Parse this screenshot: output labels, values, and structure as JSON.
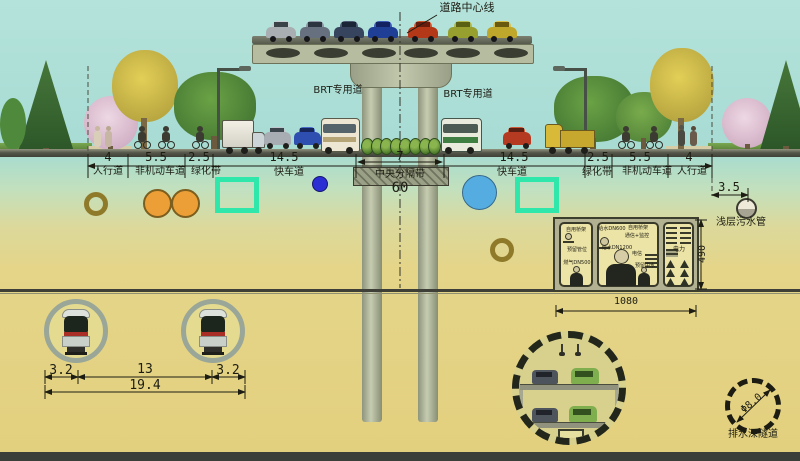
{
  "labels": {
    "road_centerline": "道路中心线",
    "brt_left": "BRT专用道",
    "brt_right": "BRT专用道",
    "median": "中央分隔带",
    "median_width": "7",
    "total_width": "60",
    "sewer_offset": "3.5",
    "shallow_sewer": "浅层污水管",
    "deep_tunnel_dia": "Φ8.0",
    "deep_tunnel": "排水深隧道"
  },
  "lanes_left": [
    {
      "width": "4",
      "name": "人行道"
    },
    {
      "width": "5.5",
      "name": "非机动车道"
    },
    {
      "width": "2.5",
      "name": "绿化带"
    },
    {
      "width": "14.5",
      "name": "快车道"
    }
  ],
  "lanes_right": [
    {
      "width": "14.5",
      "name": "快车道"
    },
    {
      "width": "2.5",
      "name": "绿化带"
    },
    {
      "width": "5.5",
      "name": "非机动车道"
    },
    {
      "width": "4",
      "name": "人行道"
    }
  ],
  "utility_gallery": {
    "width_dim": "1080",
    "height_dim": "490",
    "gas_compartment": [
      "自用桥架",
      "预留管位",
      "燃气DN500"
    ],
    "water_compartment": [
      "给水DN600",
      "自用桥架",
      "通信+监控",
      "给水DN1200",
      "电信",
      "预留中水"
    ],
    "power_compartment": [
      "电力"
    ]
  },
  "metro_tunnels": {
    "left": "3.2",
    "middle": "13",
    "right": "3.2",
    "total": "19.4"
  },
  "colors": {
    "teal_duct": "#2fe7ab",
    "pressure_pipe_orange": "#ec9f37",
    "water_pipe_blue": "#55ace0",
    "cable_navy": "#2b2ed2"
  }
}
